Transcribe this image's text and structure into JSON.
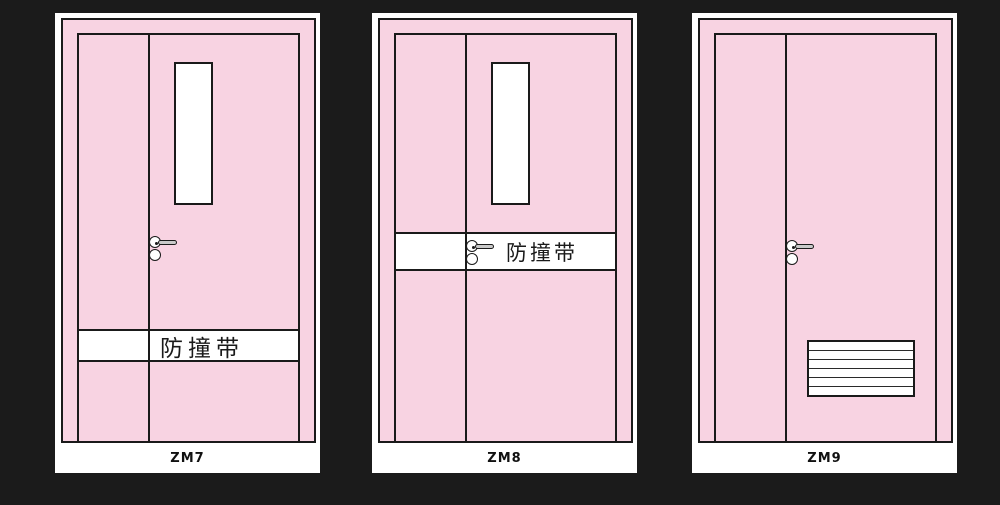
{
  "diagram": {
    "background_color": "#1b1b1b",
    "panel_color": "#ffffff",
    "door_fill_color": "#f8d3e2",
    "outline_color": "#1a1a1a",
    "handle_metal_color": "#c9c9c9"
  },
  "doors": [
    {
      "label": "ZM7",
      "strip_label": "防撞带",
      "features": [
        "vision-window",
        "lever-handle",
        "anti-collision-strip-lower"
      ]
    },
    {
      "label": "ZM8",
      "strip_label": "防撞带",
      "features": [
        "vision-window",
        "lever-handle",
        "anti-collision-strip-at-handle"
      ]
    },
    {
      "label": "ZM9",
      "features": [
        "lever-handle",
        "ventilation-louver"
      ]
    }
  ]
}
